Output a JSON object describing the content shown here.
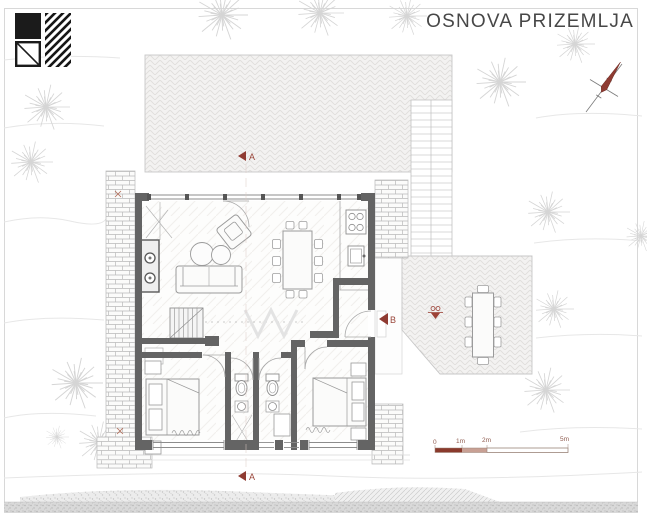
{
  "title": "OSNOVA PRIZEMLJA",
  "section_markers": {
    "top": "A",
    "bottom": "A",
    "entry": "B"
  },
  "scale_bar": {
    "labels": [
      "0",
      "1m",
      "2m",
      "5m"
    ]
  },
  "legend": {
    "items": [
      "solid-wall-swatch",
      "hatch-insulation-swatch",
      "window-opening-swatch"
    ]
  },
  "icons": [
    "north-arrow",
    "section-cut-marker",
    "elevation-marker",
    "tree",
    "radiator",
    "staircase"
  ],
  "colors": {
    "accent_red": "#8f3b32",
    "wall_gray": "#646464",
    "scale_dark": "#8a3a2c",
    "scale_light": "#c8a094",
    "paving_line": "#dedcda",
    "brick_line": "#b9b9b9"
  }
}
